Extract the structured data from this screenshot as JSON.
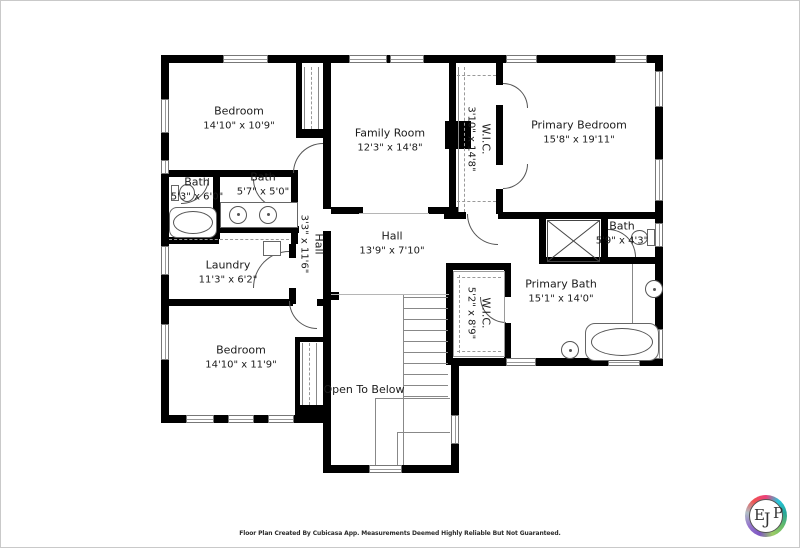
{
  "rooms": {
    "bedroom1": {
      "name": "Bedroom",
      "dims": "14'10\" x 10'9\""
    },
    "family_room": {
      "name": "Family Room",
      "dims": "12'3\" x 14'8\""
    },
    "wic1": {
      "name": "W.I.C.",
      "dims": "3'10\" x 14'8\""
    },
    "primary_bedroom": {
      "name": "Primary Bedroom",
      "dims": "15'8\" x 19'11\""
    },
    "bath1": {
      "name": "Bath",
      "dims": "5'3\" x 6'0\""
    },
    "bath2": {
      "name": "Bath",
      "dims": "5'7\" x 5'0\""
    },
    "hall1": {
      "name": "Hall",
      "dims": "3'3\" x 11'6\""
    },
    "hall2": {
      "name": "Hall",
      "dims": "13'9\" x 7'10\""
    },
    "laundry": {
      "name": "Laundry",
      "dims": "11'3\" x 6'2\""
    },
    "bedroom2": {
      "name": "Bedroom",
      "dims": "14'10\" x 11'9\""
    },
    "open_to_below": {
      "name": "Open To Below"
    },
    "wic2": {
      "name": "W.I.C.",
      "dims": "5'2\" x 8'9\""
    },
    "primary_bath": {
      "name": "Primary Bath",
      "dims": "15'1\" x 14'0\""
    },
    "bath3": {
      "name": "Bath",
      "dims": "5'9\" x 4'3\""
    }
  },
  "footer": {
    "disclaimer": "Floor Plan Created By Cubicasa App. Measurements Deemed Highly Reliable But Not Guaranteed."
  },
  "logo": {
    "e": "E",
    "j": "J",
    "p": "P"
  },
  "colors": {
    "wall": "#000000",
    "fixture_line": "#555555"
  }
}
